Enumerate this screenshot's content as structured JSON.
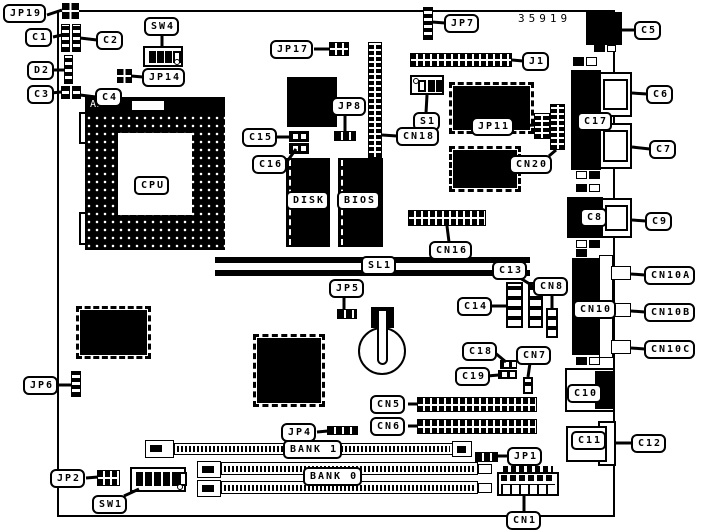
{
  "diagram": {
    "part_number": "35919",
    "socket_brand": "AMP",
    "callouts": [
      {
        "id": "jp19",
        "text": "JP19",
        "x": 3,
        "y": 4,
        "tail": [
          [
            47,
            15
          ],
          [
            62,
            10
          ]
        ]
      },
      {
        "id": "c1",
        "text": "C1",
        "x": 25,
        "y": 28,
        "tail": [
          [
            53,
            37
          ],
          [
            62,
            35
          ]
        ]
      },
      {
        "id": "c2",
        "text": "C2",
        "x": 96,
        "y": 31,
        "tail": [
          [
            97,
            40
          ],
          [
            80,
            38
          ]
        ]
      },
      {
        "id": "sw4",
        "text": "SW4",
        "x": 144,
        "y": 17,
        "tail": [
          [
            162,
            34
          ],
          [
            162,
            47
          ]
        ]
      },
      {
        "id": "d2",
        "text": "D2",
        "x": 27,
        "y": 61,
        "tail": [
          [
            52,
            70
          ],
          [
            64,
            70
          ]
        ]
      },
      {
        "id": "jp14",
        "text": "JP14",
        "x": 142,
        "y": 68,
        "tail": [
          [
            143,
            77
          ],
          [
            131,
            76
          ]
        ]
      },
      {
        "id": "c3",
        "text": "C3",
        "x": 27,
        "y": 85,
        "tail": [
          [
            51,
            93
          ],
          [
            61,
            92
          ]
        ]
      },
      {
        "id": "c4",
        "text": "C4",
        "x": 95,
        "y": 88,
        "tail": [
          [
            96,
            97
          ],
          [
            80,
            95
          ]
        ]
      },
      {
        "id": "jp17",
        "text": "JP17",
        "x": 270,
        "y": 40,
        "tail": [
          [
            314,
            49
          ],
          [
            330,
            49
          ]
        ]
      },
      {
        "id": "jp7",
        "text": "JP7",
        "x": 444,
        "y": 14,
        "tail": [
          [
            445,
            23
          ],
          [
            432,
            22
          ]
        ]
      },
      {
        "id": "c5",
        "text": "C5",
        "x": 634,
        "y": 21,
        "tail": [
          [
            635,
            30
          ],
          [
            622,
            30
          ]
        ]
      },
      {
        "id": "j1",
        "text": "J1",
        "x": 522,
        "y": 52,
        "tail": [
          [
            523,
            61
          ],
          [
            512,
            60
          ]
        ]
      },
      {
        "id": "jp8",
        "text": "JP8",
        "x": 331,
        "y": 97,
        "tail": [
          [
            345,
            114
          ],
          [
            345,
            131
          ]
        ]
      },
      {
        "id": "s1",
        "text": "S1",
        "x": 413,
        "y": 112,
        "tail": [
          [
            426,
            113
          ],
          [
            427,
            95
          ]
        ]
      },
      {
        "id": "jp11",
        "text": "JP11",
        "x": 471,
        "y": 117,
        "tail": [
          [
            517,
            126
          ],
          [
            534,
            125
          ]
        ]
      },
      {
        "id": "c15",
        "text": "C15",
        "x": 242,
        "y": 128,
        "tail": [
          [
            276,
            137
          ],
          [
            289,
            137
          ]
        ]
      },
      {
        "id": "c16",
        "text": "C16",
        "x": 252,
        "y": 155,
        "tail": [
          [
            286,
            163
          ],
          [
            296,
            149
          ]
        ]
      },
      {
        "id": "cn18",
        "text": "CN18",
        "x": 396,
        "y": 127,
        "tail": [
          [
            397,
            136
          ],
          [
            382,
            135
          ]
        ]
      },
      {
        "id": "cn20",
        "text": "CN20",
        "x": 509,
        "y": 155,
        "tail": [
          [
            549,
            156
          ],
          [
            556,
            150
          ]
        ]
      },
      {
        "id": "c6",
        "text": "C6",
        "x": 646,
        "y": 85,
        "tail": [
          [
            647,
            94
          ],
          [
            632,
            93
          ]
        ]
      },
      {
        "id": "c7",
        "text": "C7",
        "x": 649,
        "y": 140,
        "tail": [
          [
            650,
            149
          ],
          [
            632,
            147
          ]
        ]
      },
      {
        "id": "c9",
        "text": "C9",
        "x": 645,
        "y": 212,
        "tail": [
          [
            646,
            221
          ],
          [
            632,
            220
          ]
        ]
      },
      {
        "id": "cn16",
        "text": "CN16",
        "x": 429,
        "y": 241,
        "tail": [
          [
            449,
            242
          ],
          [
            447,
            226
          ]
        ]
      },
      {
        "id": "c13",
        "text": "C13",
        "x": 492,
        "y": 261,
        "tail": [
          [
            520,
            278
          ],
          [
            533,
            286
          ]
        ]
      },
      {
        "id": "cn8",
        "text": "CN8",
        "x": 533,
        "y": 277,
        "tail": [
          [
            552,
            294
          ],
          [
            552,
            309
          ]
        ]
      },
      {
        "id": "c14",
        "text": "C14",
        "x": 457,
        "y": 297,
        "tail": [
          [
            491,
            306
          ],
          [
            506,
            306
          ]
        ]
      },
      {
        "id": "cn10a",
        "text": "CN10A",
        "x": 644,
        "y": 266,
        "tail": [
          [
            645,
            275
          ],
          [
            631,
            274
          ]
        ]
      },
      {
        "id": "cn10b",
        "text": "CN10B",
        "x": 644,
        "y": 303,
        "tail": [
          [
            645,
            312
          ],
          [
            631,
            311
          ]
        ]
      },
      {
        "id": "cn10c",
        "text": "CN10C",
        "x": 644,
        "y": 340,
        "tail": [
          [
            645,
            349
          ],
          [
            631,
            348
          ]
        ]
      },
      {
        "id": "jp5",
        "text": "JP5",
        "x": 329,
        "y": 279,
        "tail": [
          [
            344,
            296
          ],
          [
            344,
            309
          ]
        ]
      },
      {
        "id": "c18",
        "text": "C18",
        "x": 462,
        "y": 342,
        "tail": [
          [
            494,
            352
          ],
          [
            506,
            362
          ]
        ]
      },
      {
        "id": "cn7",
        "text": "CN7",
        "x": 516,
        "y": 346,
        "tail": [
          [
            530,
            363
          ],
          [
            528,
            377
          ]
        ]
      },
      {
        "id": "c19",
        "text": "C19",
        "x": 455,
        "y": 367,
        "tail": [
          [
            487,
            376
          ],
          [
            499,
            375
          ]
        ]
      },
      {
        "id": "jp6",
        "text": "JP6",
        "x": 23,
        "y": 376,
        "tail": [
          [
            58,
            385
          ],
          [
            71,
            385
          ]
        ]
      },
      {
        "id": "c12",
        "text": "C12",
        "x": 631,
        "y": 434,
        "tail": [
          [
            632,
            443
          ],
          [
            616,
            443
          ]
        ]
      },
      {
        "id": "cn5",
        "text": "CN5",
        "x": 370,
        "y": 395,
        "tail": [
          [
            408,
            404
          ],
          [
            418,
            404
          ]
        ]
      },
      {
        "id": "cn6",
        "text": "CN6",
        "x": 370,
        "y": 417,
        "tail": [
          [
            408,
            426
          ],
          [
            418,
            426
          ]
        ]
      },
      {
        "id": "jp4",
        "text": "JP4",
        "x": 281,
        "y": 423,
        "tail": [
          [
            317,
            432
          ],
          [
            328,
            431
          ]
        ]
      },
      {
        "id": "jp1",
        "text": "JP1",
        "x": 507,
        "y": 447,
        "tail": [
          [
            508,
            456
          ],
          [
            497,
            456
          ]
        ]
      },
      {
        "id": "jp2",
        "text": "JP2",
        "x": 50,
        "y": 469,
        "tail": [
          [
            86,
            478
          ],
          [
            98,
            477
          ]
        ]
      },
      {
        "id": "sw1",
        "text": "SW1",
        "x": 92,
        "y": 495,
        "tail": [
          [
            124,
            496
          ],
          [
            139,
            489
          ]
        ]
      },
      {
        "id": "cn1",
        "text": "CN1",
        "x": 506,
        "y": 511,
        "tail": [
          [
            524,
            511
          ],
          [
            524,
            495
          ]
        ]
      }
    ],
    "tags": [
      {
        "id": "cpu",
        "text": "CPU",
        "x": 134,
        "y": 176
      },
      {
        "id": "disk",
        "text": "DISK",
        "x": 286,
        "y": 191
      },
      {
        "id": "bios",
        "text": "BIOS",
        "x": 337,
        "y": 191
      },
      {
        "id": "sl1",
        "text": "SL1",
        "x": 361,
        "y": 256
      },
      {
        "id": "bank1",
        "text": "BANK 1",
        "x": 283,
        "y": 440
      },
      {
        "id": "bank0",
        "text": "BANK 0",
        "x": 303,
        "y": 467
      },
      {
        "id": "c17",
        "text": "C17",
        "x": 577,
        "y": 112
      },
      {
        "id": "c8",
        "text": "C8",
        "x": 580,
        "y": 208
      },
      {
        "id": "cn10",
        "text": "CN10",
        "x": 573,
        "y": 300
      },
      {
        "id": "c10",
        "text": "C10",
        "x": 567,
        "y": 384
      },
      {
        "id": "c11",
        "text": "C11",
        "x": 571,
        "y": 431
      }
    ]
  }
}
